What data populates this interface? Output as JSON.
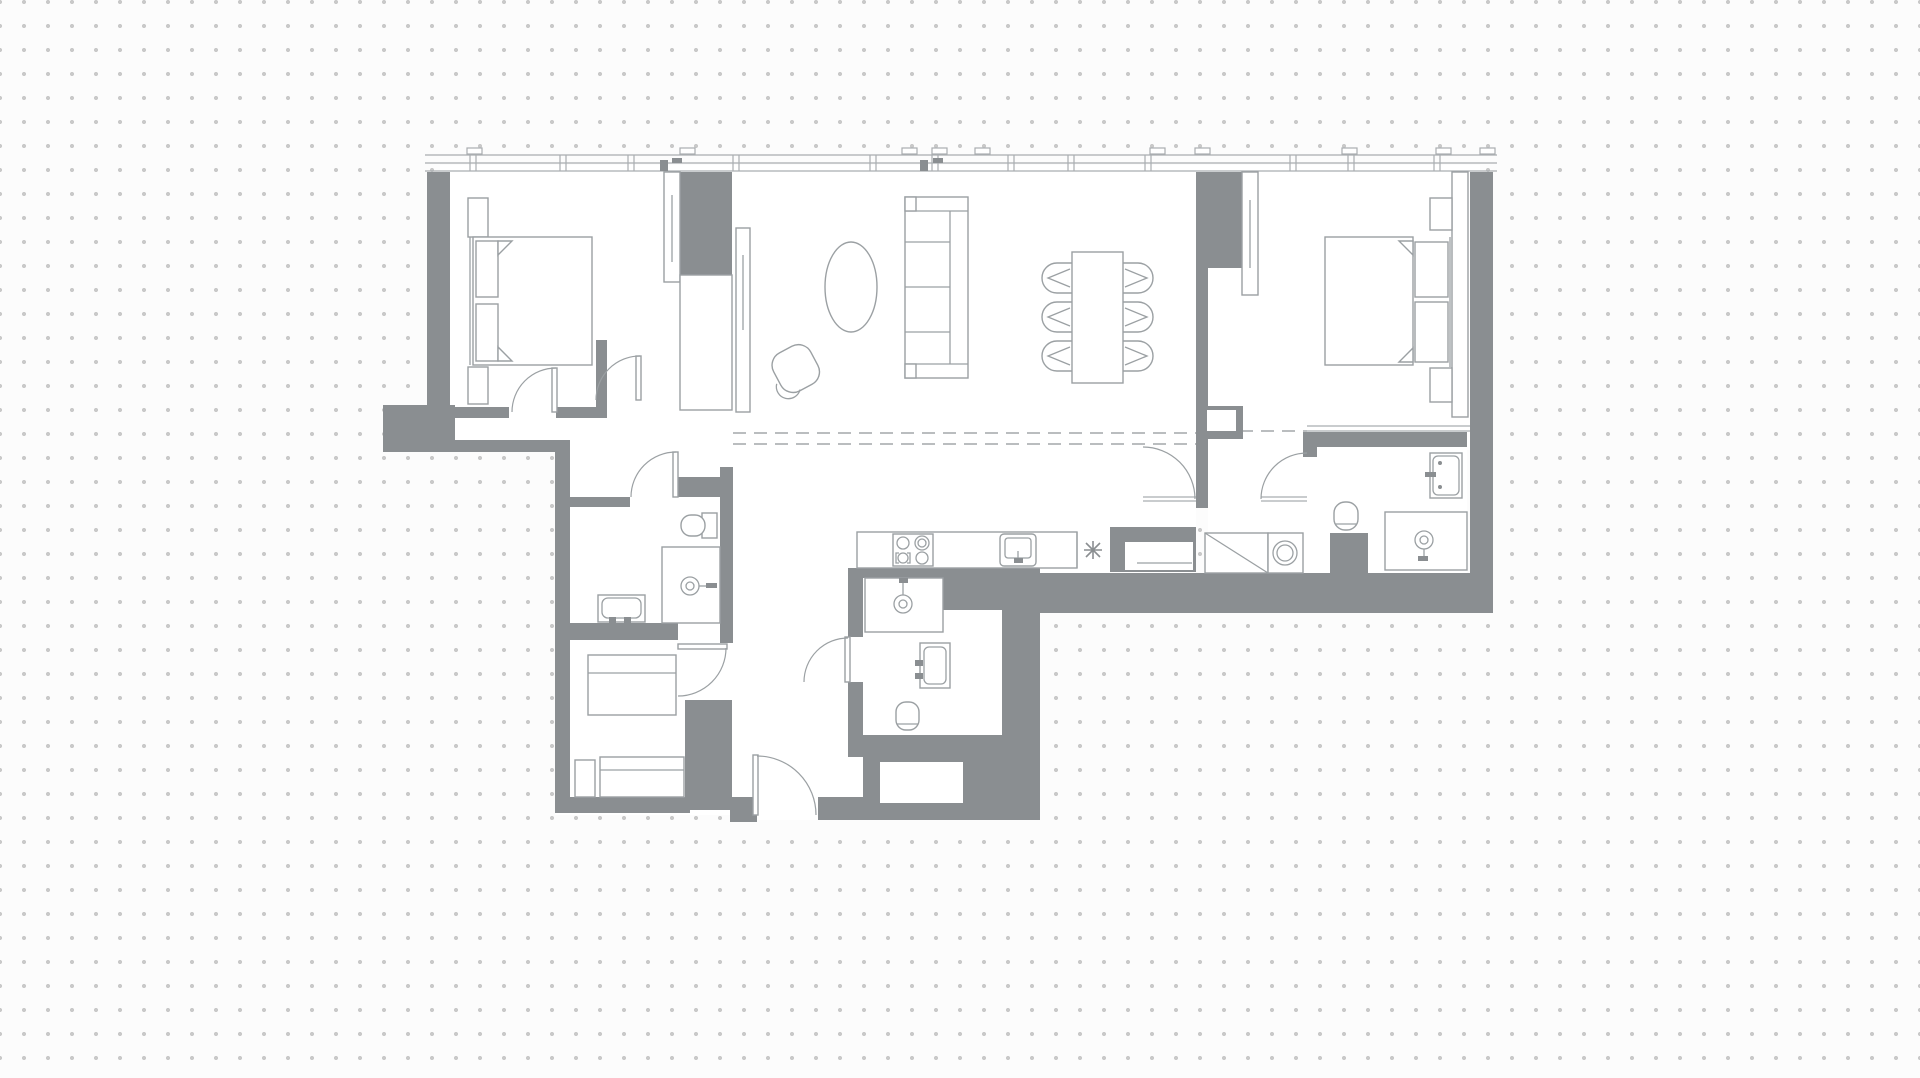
{
  "canvas": {
    "width": 1920,
    "height": 1078
  },
  "palette": {
    "background": "#fcfcfc",
    "dot": "#c9c9c9",
    "wall": "#8a8e91",
    "line_light": "#a9adb0",
    "furniture_line": "#9ba0a3",
    "floor": "#ffffff",
    "dash": "#a3a7aa"
  },
  "plan": {
    "type": "apartment-floor-plan",
    "rooms": [
      {
        "name": "bedroom-1",
        "furniture": [
          "double-bed",
          "nightstand",
          "nightstand",
          "sliding-wardrobe"
        ]
      },
      {
        "name": "living-dining-room",
        "furniture": [
          "sofa",
          "armchair",
          "oval-coffee-table",
          "dining-table",
          "dining-chair-x6"
        ]
      },
      {
        "name": "kitchen",
        "furniture": [
          "cooktop-4-burner",
          "kitchen-sink",
          "refrigerator-niche",
          "freezer-mark"
        ]
      },
      {
        "name": "bedroom-2",
        "furniture": [
          "double-bed",
          "nightstand",
          "nightstand",
          "sliding-wardrobe",
          "closet"
        ]
      },
      {
        "name": "bathroom-1",
        "furniture": [
          "toilet",
          "shower-tray",
          "washbasin"
        ]
      },
      {
        "name": "bathroom-2",
        "furniture": [
          "shower-tray",
          "washbasin",
          "toilet",
          "duct"
        ]
      },
      {
        "name": "bathroom-3",
        "furniture": [
          "washbasin",
          "toilet",
          "shower-tray"
        ]
      },
      {
        "name": "hallway",
        "furniture": [
          "closet-diagonal",
          "washing-machine"
        ]
      },
      {
        "name": "entrance-hall",
        "furniture": [
          "wardrobe-shelves",
          "wardrobe-shelves",
          "entrance-door"
        ]
      }
    ],
    "door_count": 8,
    "window_wall": "glazed-facade-top",
    "annotations": {
      "dashed_zone_lines": 2
    }
  }
}
